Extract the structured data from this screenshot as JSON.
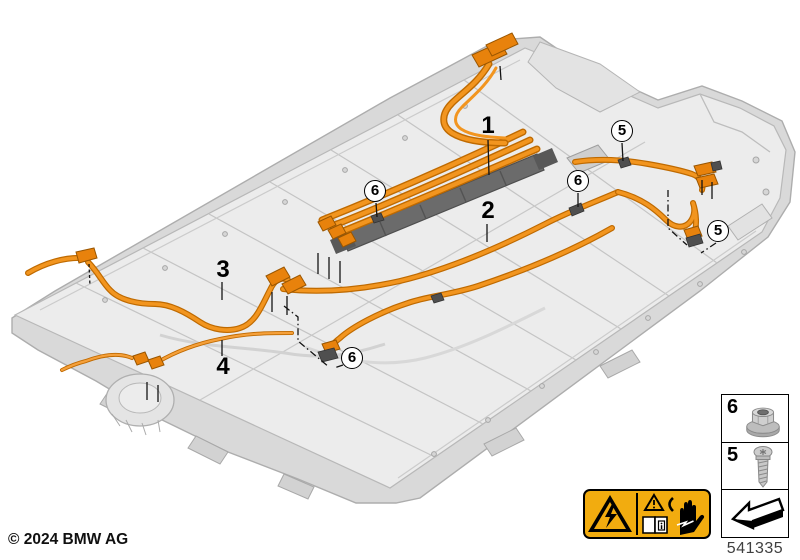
{
  "figure": {
    "copyright": "© 2024 BMW AG",
    "part_number": "541335"
  },
  "callouts": {
    "plain": [
      {
        "label": "1"
      },
      {
        "label": "2"
      },
      {
        "label": "3"
      },
      {
        "label": "4"
      }
    ],
    "circled": [
      {
        "label": "5"
      },
      {
        "label": "5"
      },
      {
        "label": "6"
      },
      {
        "label": "6"
      },
      {
        "label": "6"
      }
    ]
  },
  "legend": {
    "rows": [
      {
        "label": "6",
        "icon": "flange-nut-icon"
      },
      {
        "label": "5",
        "icon": "torx-screw-icon"
      }
    ],
    "direction_icon": "installation-direction-arrow-icon"
  },
  "warning_label": {
    "icons": [
      "electric-shock-hazard-triangle-icon",
      "warning-triangle-icon",
      "read-manual-book-icon",
      "hand-electric-shock-icon"
    ],
    "background": "#F2AC0F"
  },
  "colors": {
    "cable_orange": "#F2951F",
    "cable_outline": "#BF6A00",
    "connector_orange": "#E8820C",
    "pack_top_gray": "#ECECEC",
    "pack_side_gray": "#D9D9D9",
    "duct_gray": "#6B6B6B",
    "label_amber": "#F2AC0F"
  }
}
